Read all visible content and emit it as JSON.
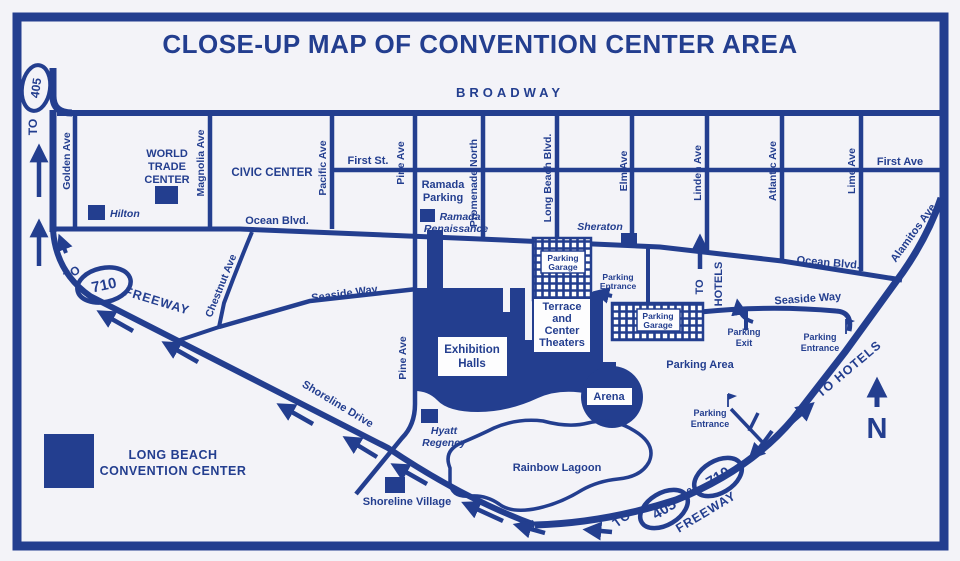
{
  "title": "CLOSE-UP MAP OF CONVENTION CENTER AREA",
  "colors": {
    "ink": "#233E8F",
    "paper": "#F3F3F8",
    "white": "#FDFDFE"
  },
  "streets": {
    "broadway": "BROADWAY",
    "golden": "Golden Ave",
    "magnolia": "Magnolia Ave",
    "pacific": "Pacific Ave",
    "pine": "Pine Ave",
    "pine_lower": "Pine Ave",
    "promenade_north": "Promenade North",
    "long_beach_blvd": "Long Beach Blvd.",
    "elm": "Elm Ave",
    "linden": "Linden Ave",
    "atlantic": "Atlantic Ave",
    "lime": "Lime Ave",
    "first_st": "First St.",
    "first_ave": "First Ave",
    "ocean_blvd_west": "Ocean Blvd.",
    "ocean_blvd_east": "Ocean Blvd.",
    "chestnut": "Chestnut Ave",
    "alamitos": "Alamitos Ave",
    "seaside_way_west": "Seaside Way",
    "seaside_way_east": "Seaside Way",
    "shoreline_drive": "Shoreline Drive"
  },
  "places": {
    "civic_center": "CIVIC CENTER",
    "world_trade": [
      "WORLD",
      "TRADE",
      "CENTER"
    ],
    "hilton": "Hilton",
    "ramada_parking": [
      "Ramada",
      "Parking"
    ],
    "ramada_renaissance": [
      "Ramada",
      "Renaissance"
    ],
    "sheraton": "Sheraton",
    "hyatt": [
      "Hyatt",
      "Regency"
    ],
    "exhibition_halls": [
      "Exhibition",
      "Halls"
    ],
    "terrace": [
      "Terrace",
      "and",
      "Center",
      "Theaters"
    ],
    "arena": "Arena",
    "rainbow_lagoon": "Rainbow Lagoon",
    "shoreline_village": "Shoreline Village"
  },
  "parking": {
    "garage": [
      "Parking",
      "Garage"
    ],
    "entrance": [
      "Parking",
      "Entrance"
    ],
    "exit": [
      "Parking",
      "Exit"
    ],
    "area": "Parking Area"
  },
  "routes": {
    "to": "TO",
    "freeway": "FREEWAY",
    "amp": "&",
    "i405": "405",
    "i710": "710",
    "hotels": "HOTELS",
    "to_hotels": "TO HOTELS"
  },
  "legend": {
    "line1": "LONG BEACH",
    "line2": "CONVENTION CENTER"
  },
  "compass": "N"
}
